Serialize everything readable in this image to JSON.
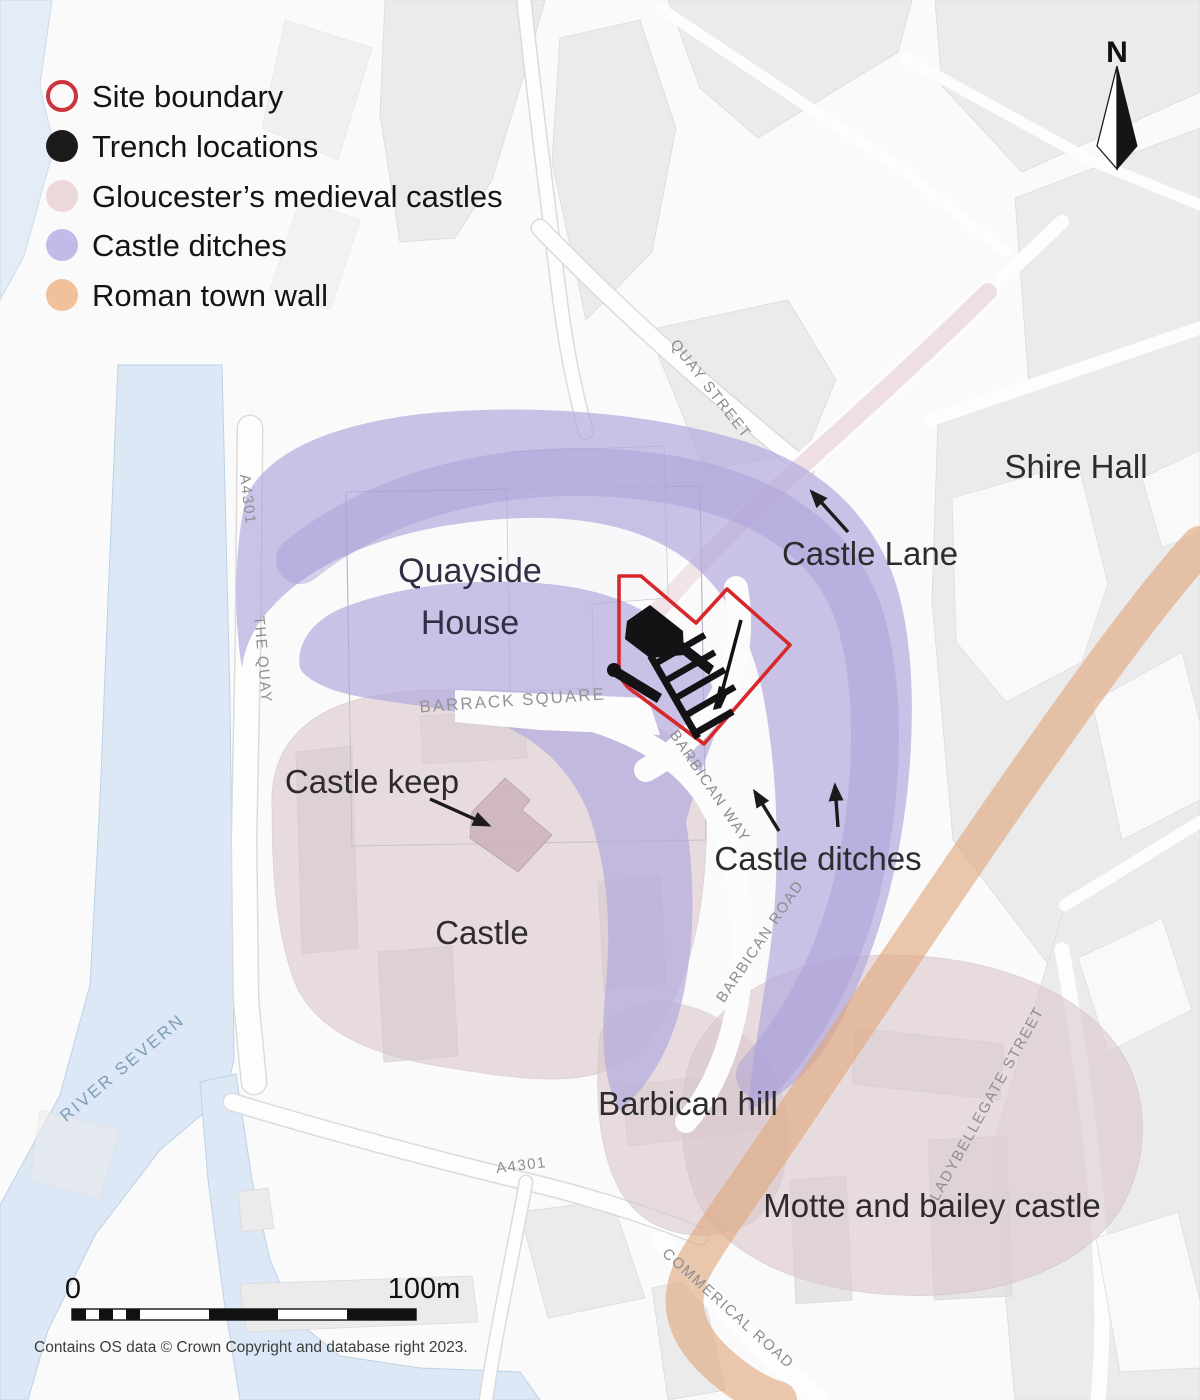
{
  "legend": {
    "items": [
      {
        "id": "site-boundary",
        "label": "Site boundary",
        "swatch": "outline",
        "color": "#c9353a"
      },
      {
        "id": "trench-locations",
        "label": "Trench locations",
        "swatch": "filled",
        "color": "#1c1a1b"
      },
      {
        "id": "medieval-castles",
        "label": "Gloucester’s medieval castles",
        "swatch": "filled",
        "color": "#ebd8da"
      },
      {
        "id": "castle-ditches",
        "label": "Castle ditches",
        "swatch": "filled",
        "color": "#c2bae9"
      },
      {
        "id": "roman-town-wall",
        "label": "Roman town wall",
        "swatch": "filled",
        "color": "#f0c19b"
      }
    ]
  },
  "compass": {
    "label": "N"
  },
  "map": {
    "place_labels": [
      {
        "id": "shire-hall",
        "text": "Shire Hall"
      },
      {
        "id": "castle-lane",
        "text": "Castle Lane"
      },
      {
        "id": "quayside-house-1",
        "text": "Quayside"
      },
      {
        "id": "quayside-house-2",
        "text": "House"
      },
      {
        "id": "castle-keep",
        "text": "Castle keep"
      },
      {
        "id": "castle",
        "text": "Castle"
      },
      {
        "id": "castle-ditches",
        "text": "Castle ditches"
      },
      {
        "id": "barbican-hill",
        "text": "Barbican hill"
      },
      {
        "id": "motte-bailey-castle",
        "text": "Motte and bailey castle"
      }
    ],
    "street_labels": [
      {
        "id": "quay-street",
        "text": "QUAY STREET"
      },
      {
        "id": "a4301-north",
        "text": "A4301"
      },
      {
        "id": "the-quay",
        "text": "THE QUAY"
      },
      {
        "id": "river-severn",
        "text": "RIVER SEVERN"
      },
      {
        "id": "barrack-square",
        "text": "BARRACK SQUARE"
      },
      {
        "id": "barbican-way",
        "text": "BARBICAN WAY"
      },
      {
        "id": "barbican-road",
        "text": "BARBICAN ROAD"
      },
      {
        "id": "ladybellegate-street",
        "text": "LADYBELLEGATE STREET"
      },
      {
        "id": "commerical-road",
        "text": "COMMERICAL ROAD"
      },
      {
        "id": "a4301-south",
        "text": "A4301"
      }
    ]
  },
  "scale_bar": {
    "start_label": "0",
    "end_label": "100m"
  },
  "attribution": "Contains OS data © Crown Copyright and database right 2023.",
  "colors": {
    "site_boundary": "#d7282c",
    "trench": "#141214",
    "medieval_castles": "#dac8cd",
    "castle_ditches": "#b3a9dd",
    "roman_wall": "#dfa87c",
    "river": "#dce8f6"
  }
}
